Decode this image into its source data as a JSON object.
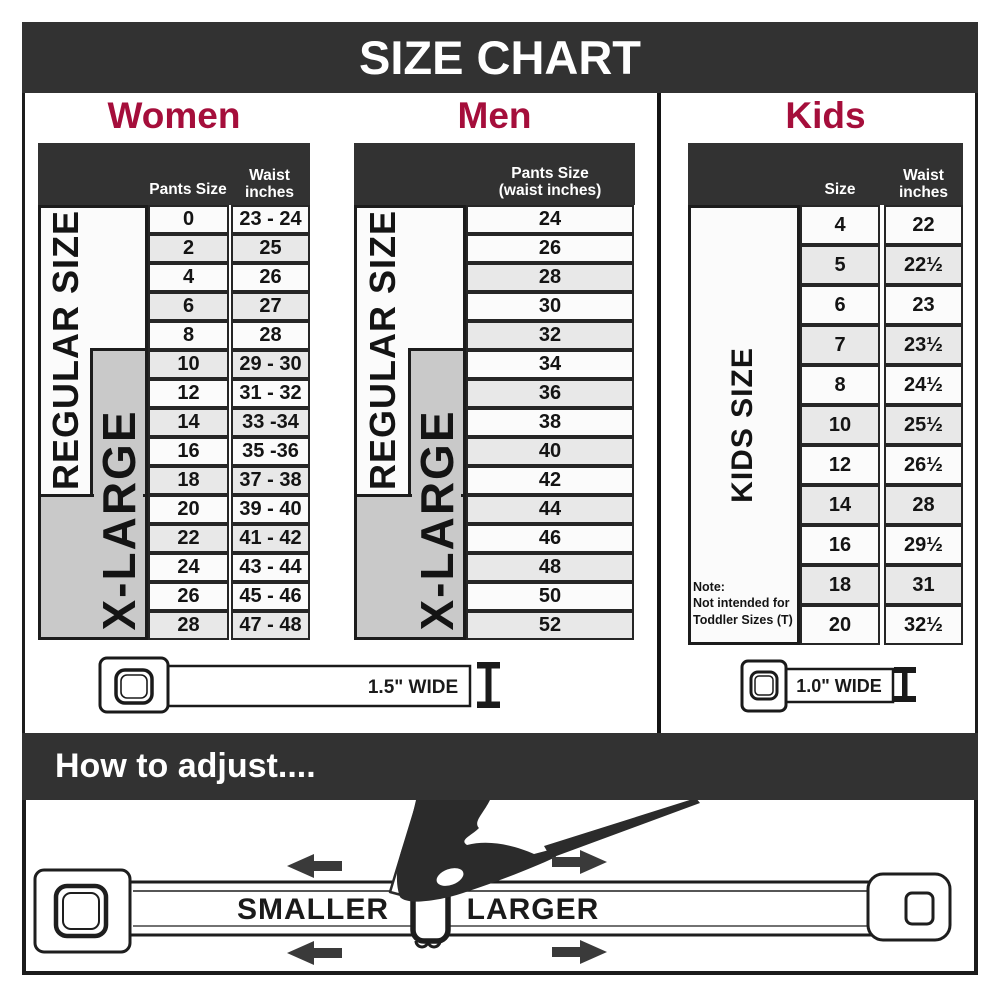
{
  "title": "SIZE CHART",
  "sections": {
    "women": {
      "heading": "Women",
      "columns": {
        "pants": "Pants Size",
        "waist_line1": "Waist",
        "waist_line2": "inches"
      },
      "regular_label": "REGULAR SIZE",
      "xlarge_label": "X-LARGE",
      "rows": [
        {
          "size": "0",
          "waist": "23 - 24",
          "shaded": false
        },
        {
          "size": "2",
          "waist": "25",
          "shaded": true
        },
        {
          "size": "4",
          "waist": "26",
          "shaded": false
        },
        {
          "size": "6",
          "waist": "27",
          "shaded": true
        },
        {
          "size": "8",
          "waist": "28",
          "shaded": false
        },
        {
          "size": "10",
          "waist": "29 - 30",
          "shaded": true
        },
        {
          "size": "12",
          "waist": "31 - 32",
          "shaded": false
        },
        {
          "size": "14",
          "waist": "33 -34",
          "shaded": true
        },
        {
          "size": "16",
          "waist": "35 -36",
          "shaded": false
        },
        {
          "size": "18",
          "waist": "37 - 38",
          "shaded": true
        },
        {
          "size": "20",
          "waist": "39 - 40",
          "shaded": false
        },
        {
          "size": "22",
          "waist": "41 - 42",
          "shaded": true
        },
        {
          "size": "24",
          "waist": "43 - 44",
          "shaded": false
        },
        {
          "size": "26",
          "waist": "45 - 46",
          "shaded": false
        },
        {
          "size": "28",
          "waist": "47 - 48",
          "shaded": true
        }
      ]
    },
    "men": {
      "heading": "Men",
      "columns": {
        "header_line1": "Pants Size",
        "header_line2": "(waist inches)"
      },
      "regular_label": "REGULAR SIZE",
      "xlarge_label": "X-LARGE",
      "rows": [
        {
          "size": "24",
          "shaded": false
        },
        {
          "size": "26",
          "shaded": false
        },
        {
          "size": "28",
          "shaded": true
        },
        {
          "size": "30",
          "shaded": false
        },
        {
          "size": "32",
          "shaded": true
        },
        {
          "size": "34",
          "shaded": false
        },
        {
          "size": "36",
          "shaded": true
        },
        {
          "size": "38",
          "shaded": false
        },
        {
          "size": "40",
          "shaded": true
        },
        {
          "size": "42",
          "shaded": false
        },
        {
          "size": "44",
          "shaded": true
        },
        {
          "size": "46",
          "shaded": false
        },
        {
          "size": "48",
          "shaded": true
        },
        {
          "size": "50",
          "shaded": false
        },
        {
          "size": "52",
          "shaded": true
        }
      ]
    },
    "kids": {
      "heading": "Kids",
      "columns": {
        "size": "Size",
        "waist_line1": "Waist",
        "waist_line2": "inches"
      },
      "label": "KIDS SIZE",
      "note_line1": "Note:",
      "note_line2": "Not intended for",
      "note_line3": "Toddler Sizes (T)",
      "rows": [
        {
          "size": "4",
          "waist": "22",
          "shaded": false
        },
        {
          "size": "5",
          "waist": "22½",
          "shaded": true
        },
        {
          "size": "6",
          "waist": "23",
          "shaded": false
        },
        {
          "size": "7",
          "waist": "23½",
          "shaded": true
        },
        {
          "size": "8",
          "waist": "24½",
          "shaded": false
        },
        {
          "size": "10",
          "waist": "25½",
          "shaded": true
        },
        {
          "size": "12",
          "waist": "26½",
          "shaded": false
        },
        {
          "size": "14",
          "waist": "28",
          "shaded": true
        },
        {
          "size": "16",
          "waist": "29½",
          "shaded": false
        },
        {
          "size": "18",
          "waist": "31",
          "shaded": true
        },
        {
          "size": "20",
          "waist": "32½",
          "shaded": false
        }
      ]
    }
  },
  "belts": {
    "adult_width_label": "1.5\" WIDE",
    "kids_width_label": "1.0\" WIDE"
  },
  "adjust": {
    "heading": "How to adjust....",
    "smaller_label": "SMALLER",
    "larger_label": "LARGER"
  },
  "colors": {
    "banner_bg": "#323232",
    "heading_red": "#A50E3B",
    "shaded_row": "#E8E8E8",
    "plain_row": "#FBFBFB",
    "gray_label_box": "#C9C9C9",
    "cell_border": "#262626",
    "arrow": "#3A3A3A",
    "text_dark": "#1A1A1A"
  }
}
